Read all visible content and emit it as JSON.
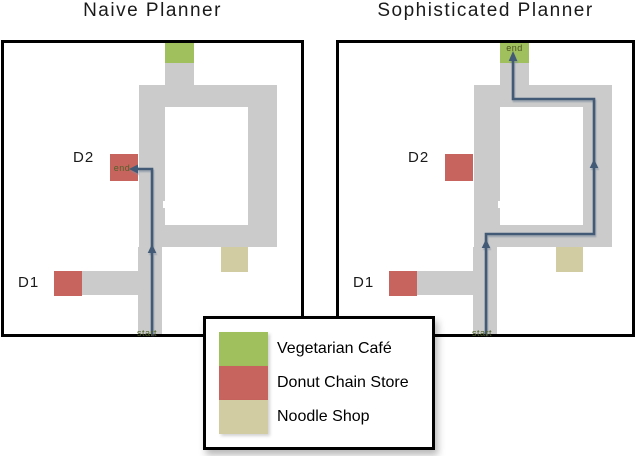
{
  "figure": {
    "panels": [
      {
        "id": "naive",
        "title": "Naive Planner",
        "d1_label": "D1",
        "d2_label": "D2",
        "start_label": "start",
        "end_label": "end",
        "end_location": "donut-chain-store-d2",
        "path_description": "Path goes from start straight up the center corridor and turns left, ending at the D2 donut chain store."
      },
      {
        "id": "sophisticated",
        "title": "Sophisticated Planner",
        "d1_label": "D1",
        "d2_label": "D2",
        "start_label": "start",
        "end_label": "end",
        "end_location": "vegetarian-cafe",
        "path_description": "Path goes up from start, detours right around the loop avoiding D2, and ends at the vegetarian cafe at top."
      }
    ],
    "legend": {
      "items": [
        {
          "key": "vegetarian-cafe",
          "label": "Vegetarian Café",
          "color": "#a0c05e"
        },
        {
          "key": "donut-chain-store",
          "label": "Donut Chain Store",
          "color": "#c8645e"
        },
        {
          "key": "noodle-shop",
          "label": "Noodle Shop",
          "color": "#d2cca3"
        }
      ]
    }
  },
  "colors": {
    "corridor": "#cbcbcb",
    "cafe": "#a0c05e",
    "donut": "#c8645e",
    "noodle": "#d2cca3",
    "path": "#425a75",
    "olive": "#4f6228"
  }
}
